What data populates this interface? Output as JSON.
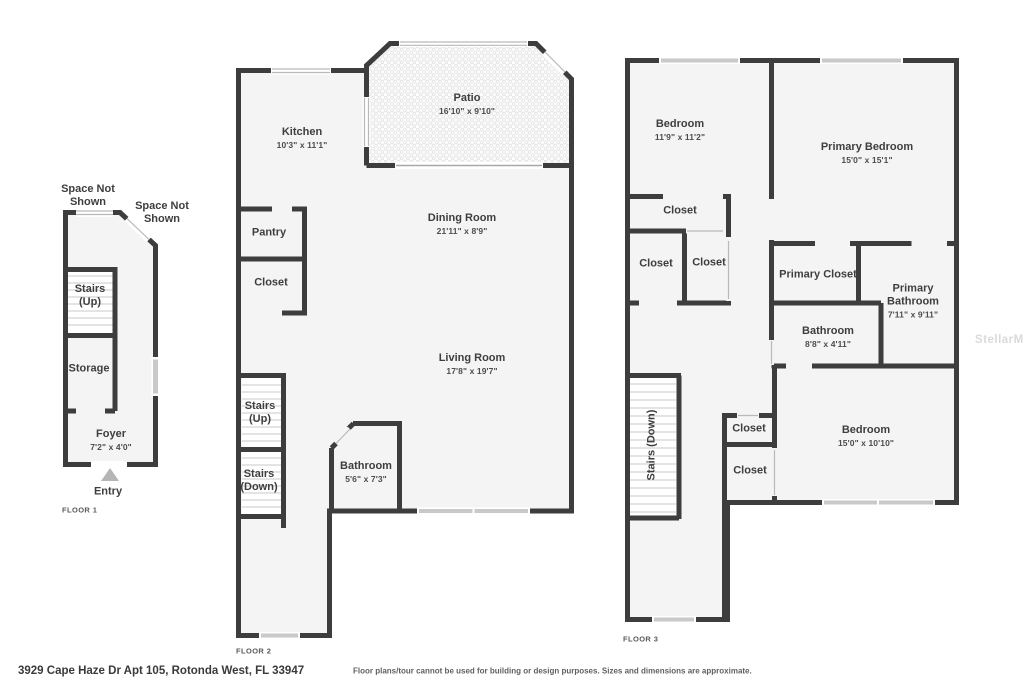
{
  "floor1": {
    "tag": "FLOOR 1",
    "space_not_shown_left": "Space Not Shown",
    "space_not_shown_right": "Space Not Shown",
    "stairs_up": "Stairs (Up)",
    "storage": "Storage",
    "foyer": {
      "name": "Foyer",
      "dims": "7'2\" x 4'0\""
    },
    "entry": "Entry"
  },
  "floor2": {
    "tag": "FLOOR 2",
    "kitchen": {
      "name": "Kitchen",
      "dims": "10'3\" x 11'1\""
    },
    "patio": {
      "name": "Patio",
      "dims": "16'10\" x 9'10\""
    },
    "dining_room": {
      "name": "Dining Room",
      "dims": "21'11\" x 8'9\""
    },
    "pantry": {
      "name": "Pantry"
    },
    "closet": {
      "name": "Closet"
    },
    "living_room": {
      "name": "Living Room",
      "dims": "17'8\" x 19'7\""
    },
    "stairs_up": "Stairs (Up)",
    "stairs_down": "Stairs (Down)",
    "bathroom": {
      "name": "Bathroom",
      "dims": "5'6\" x 7'3\""
    }
  },
  "floor3": {
    "tag": "FLOOR 3",
    "bedroom": {
      "name": "Bedroom",
      "dims": "11'9\" x 11'2\""
    },
    "primary_bedroom": {
      "name": "Primary Bedroom",
      "dims": "15'0\" x 15'1\""
    },
    "closet_top": {
      "name": "Closet"
    },
    "closet_left": {
      "name": "Closet"
    },
    "closet_mid": {
      "name": "Closet"
    },
    "primary_closet": {
      "name": "Primary Closet"
    },
    "primary_bathroom": {
      "name": "Primary Bathroom",
      "dims": "7'11\" x 9'11\""
    },
    "bathroom": {
      "name": "Bathroom",
      "dims": "8'8\" x 4'11\""
    },
    "stairs_down": "Stairs (Down)",
    "closet_hall": {
      "name": "Closet"
    },
    "closet_bed": {
      "name": "Closet"
    },
    "bedroom2": {
      "name": "Bedroom",
      "dims": "15'0\" x 10'10\""
    }
  },
  "footer": {
    "address": "3929 Cape Haze Dr Apt 105, Rotonda West, FL 33947",
    "disclaimer": "Floor plans/tour cannot be used for building or design purposes. Sizes and dimensions are approximate."
  },
  "watermark": "StellarMLS",
  "colors": {
    "wall": "#3d3d3d",
    "room_fill": "#f4f4f4",
    "window": "#c9c9c9"
  }
}
